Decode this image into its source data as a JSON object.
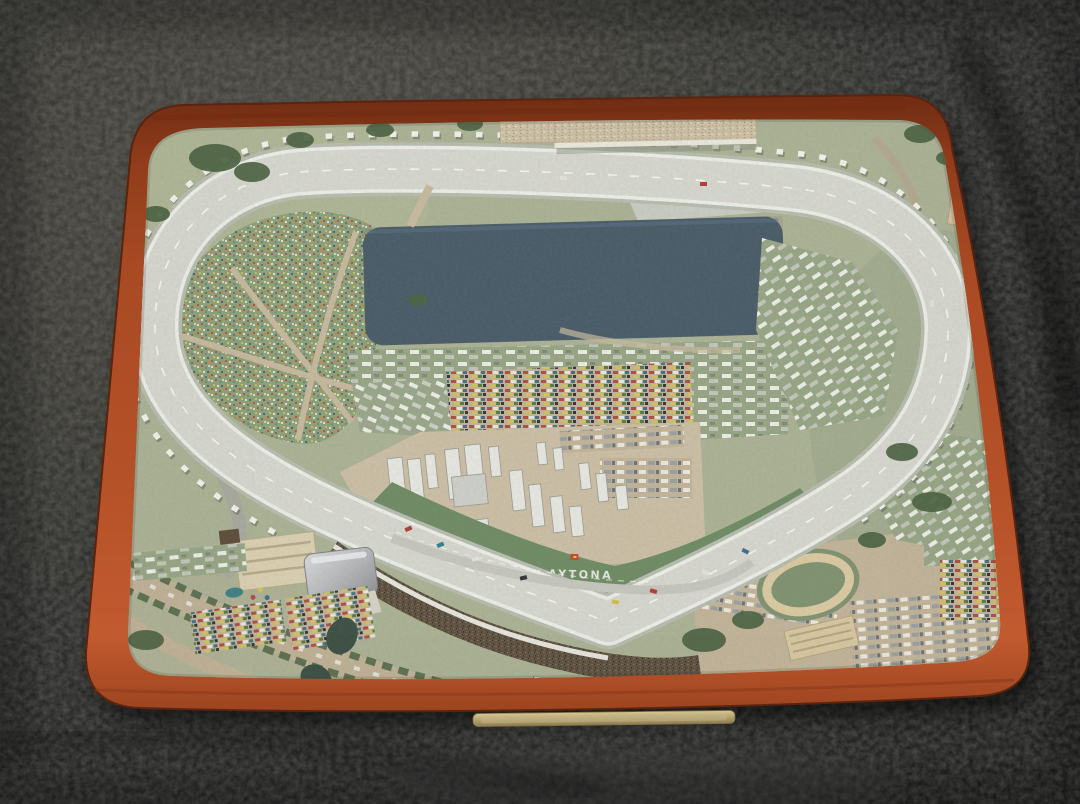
{
  "scene": {
    "description": "Photograph of a miniature diorama model of Daytona International Speedway mounted on an orange-brown wooden base with a brass nameplate, resting on black pebbled leather",
    "infield_label": "DAYTONA"
  },
  "colors": {
    "leather_dark": "#121214",
    "leather_light": "#403c39",
    "wood_light": "#bf5530",
    "wood_dark": "#7c2f16",
    "terrain": "#abb295",
    "track": "#d8d8d1",
    "track_edge": "#eef0ea",
    "lake": "#41556a",
    "grandstand_tan": "#cec1a6",
    "grandstand_brown": "#5c4e3e",
    "nameplate_gold": "#c4b489",
    "sign_blue": "#4187c0",
    "infield_grass": "#6d8a63",
    "road_gray": "#a8a89f",
    "road_tan": "#c3b499",
    "tree_green": "#49603f"
  }
}
